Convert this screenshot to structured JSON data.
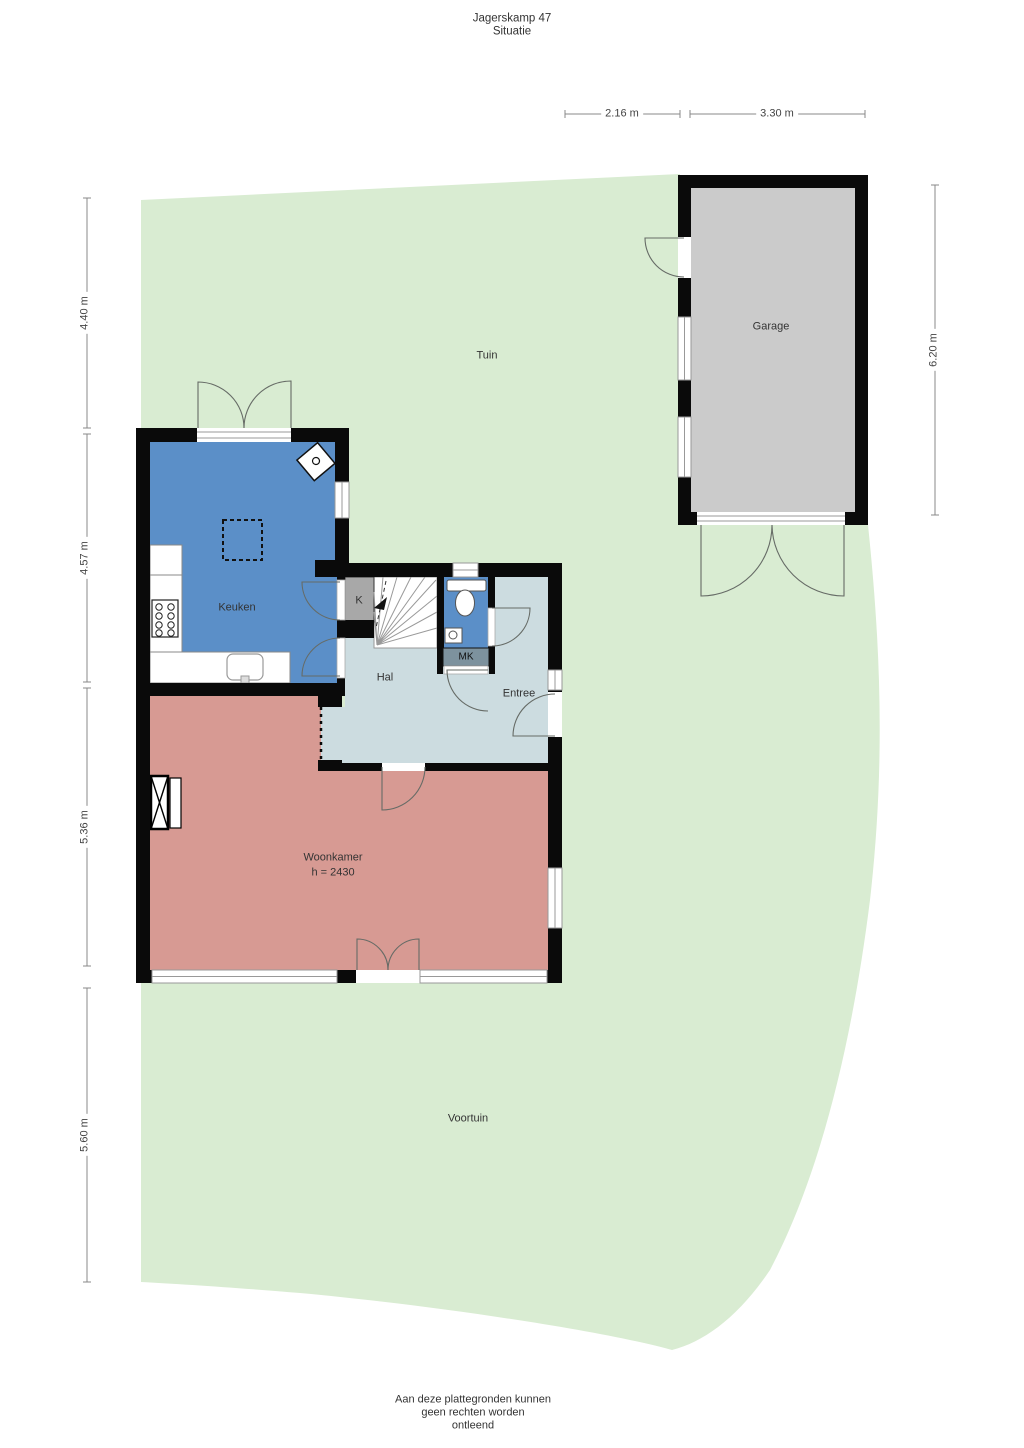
{
  "title": {
    "line1": "Jagerskamp 47",
    "line2": "Situatie"
  },
  "dimensions": {
    "top": [
      "2.16 m",
      "3.30 m"
    ],
    "left": [
      "4.40 m",
      "4.57 m",
      "5.36 m",
      "5.60 m"
    ],
    "right": [
      "6.20 m"
    ]
  },
  "rooms": {
    "tuin": "Tuin",
    "garage": "Garage",
    "keuken": "Keuken",
    "kast": "K",
    "hal": "Hal",
    "meterkast": "MK",
    "entree": "Entree",
    "woonkamer": "Woonkamer",
    "woonkamer_height": "h = 2430",
    "voortuin": "Voortuin"
  },
  "footer": {
    "line1": "Aan deze plattegronden kunnen",
    "line2": "geen rechten worden",
    "line3": "ontleend"
  },
  "colors": {
    "green": "#d9ecd2",
    "garage_gray": "#cbcbcb",
    "closet_gray": "#a8a8a8",
    "blue": "#5b8fc8",
    "hal": "#ccdce0",
    "pink": "#d79a93",
    "mk": "#7d929e",
    "wall": "#0a0a0a",
    "dim": "#888888",
    "text": "#333333"
  }
}
